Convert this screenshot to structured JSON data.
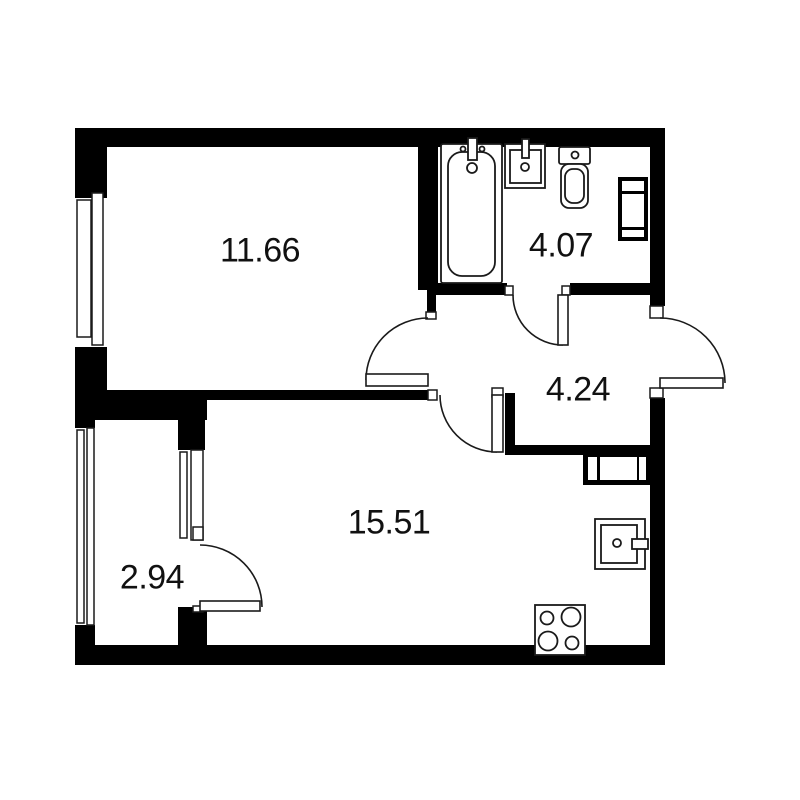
{
  "plan": {
    "canvas": {
      "width": 800,
      "height": 800
    },
    "colors": {
      "background": "#ffffff",
      "wall": "#000000",
      "line": "#1a1a1a",
      "fixture_fill": "#ffffff"
    },
    "rooms": [
      {
        "id": "room-1",
        "area": "11.66",
        "label_x": 260,
        "label_y": 251
      },
      {
        "id": "bathroom",
        "area": "4.07",
        "label_x": 561,
        "label_y": 246
      },
      {
        "id": "hallway",
        "area": "4.24",
        "label_x": 578,
        "label_y": 390
      },
      {
        "id": "kitchen-living",
        "area": "15.51",
        "label_x": 389,
        "label_y": 523
      },
      {
        "id": "balcony",
        "area": "2.94",
        "label_x": 152,
        "label_y": 578
      }
    ],
    "walls": [
      [
        75,
        128,
        590,
        19
      ],
      [
        75,
        147,
        32,
        51
      ],
      [
        75,
        347,
        32,
        43
      ],
      [
        75,
        390,
        132,
        30
      ],
      [
        75,
        420,
        20,
        10
      ],
      [
        75,
        625,
        20,
        22
      ],
      [
        75,
        645,
        590,
        20
      ],
      [
        650,
        128,
        15,
        178
      ],
      [
        650,
        398,
        15,
        247
      ],
      [
        418,
        147,
        20,
        143
      ],
      [
        427,
        290,
        9,
        22
      ],
      [
        207,
        390,
        230,
        10
      ],
      [
        178,
        390,
        27,
        60
      ],
      [
        178,
        607,
        29,
        38
      ],
      [
        430,
        283,
        77,
        12
      ],
      [
        570,
        283,
        80,
        12
      ],
      [
        505,
        393,
        10,
        62
      ],
      [
        505,
        445,
        160,
        10
      ]
    ],
    "windows": [
      {
        "bg": [
          75,
          198,
          20,
          149
        ],
        "strips": [
          [
            77,
            200,
            14,
            137
          ],
          [
            92,
            193,
            11,
            152
          ]
        ]
      },
      {
        "bg": [
          75,
          428,
          20,
          197
        ],
        "strips": [
          [
            77,
            430,
            7,
            193
          ],
          [
            87,
            428,
            7,
            197
          ]
        ]
      },
      {
        "bg": [
          178,
          450,
          27,
          90
        ],
        "strips": [
          [
            180,
            452,
            7,
            86
          ],
          [
            191,
            450,
            12,
            90
          ]
        ]
      }
    ],
    "frames": [
      [
        426,
        312,
        10,
        7
      ],
      [
        428,
        390,
        9,
        10
      ],
      [
        505,
        286,
        8,
        9
      ],
      [
        562,
        286,
        8,
        9
      ],
      [
        492,
        388,
        11,
        9
      ],
      [
        650,
        306,
        13,
        12
      ],
      [
        650,
        388,
        13,
        10
      ],
      [
        193,
        527,
        10,
        13
      ],
      [
        193,
        606,
        10,
        6
      ]
    ],
    "doors": [
      {
        "name": "door-room-1",
        "leaf": [
          366,
          374,
          62,
          12
        ],
        "arc": "M 428 318 A 62 62 0 0 0 366 380"
      },
      {
        "name": "door-bathroom",
        "leaf": [
          558,
          295,
          10,
          50
        ],
        "arc": "M 513 295 A 50 50 0 0 0 563 345"
      },
      {
        "name": "door-kitchen-living",
        "leaf": [
          492,
          395,
          11,
          57
        ],
        "arc": "M 440 395 A 57 57 0 0 0 497 452"
      },
      {
        "name": "door-balcony",
        "leaf": [
          200,
          601,
          60,
          10
        ],
        "arc": "M 200 545 A 62 62 0 0 1 262 607"
      },
      {
        "name": "door-entrance",
        "leaf": [
          660,
          378,
          63,
          10
        ],
        "arc": "M 660 318 A 65 65 0 0 1 725 383"
      }
    ],
    "fixtures": [
      {
        "name": "bathtub",
        "rects": [
          [
            441,
            144,
            61,
            139,
            2
          ],
          [
            448,
            152,
            47,
            124,
            14
          ],
          [
            468,
            138,
            9,
            22,
            0
          ]
        ],
        "circles": [
          [
            463,
            149,
            2.5
          ],
          [
            482,
            149,
            2.5
          ],
          [
            472,
            168,
            5
          ]
        ]
      },
      {
        "name": "bathroom-sink",
        "rects": [
          [
            505,
            144,
            40,
            44,
            0
          ],
          [
            510,
            150,
            31,
            33,
            0
          ],
          [
            522,
            139,
            7,
            19,
            0
          ]
        ],
        "circles": [
          [
            525,
            167,
            4
          ]
        ]
      },
      {
        "name": "toilet",
        "rects": [
          [
            559,
            147,
            31,
            17,
            2
          ],
          [
            561,
            164,
            27,
            44,
            8
          ],
          [
            565,
            169,
            19,
            34,
            8
          ]
        ],
        "circles": [
          [
            575,
            155,
            3.5
          ]
        ]
      },
      {
        "name": "vent-shaft",
        "black_rects": [
          [
            618,
            177,
            30,
            64
          ]
        ],
        "white_rects": [
          [
            622,
            181,
            22,
            10
          ],
          [
            622,
            194,
            22,
            33
          ],
          [
            622,
            230,
            22,
            7
          ]
        ]
      },
      {
        "name": "entry-closet",
        "black_rects": [
          [
            583,
            452,
            67,
            33
          ]
        ],
        "white_rects": [
          [
            588,
            457,
            9,
            23
          ],
          [
            600,
            457,
            37,
            23
          ],
          [
            639,
            457,
            7,
            23
          ]
        ]
      },
      {
        "name": "kitchen-sink",
        "rects": [
          [
            595,
            519,
            50,
            50,
            0
          ],
          [
            601,
            525,
            36,
            38,
            0
          ],
          [
            632,
            539,
            16,
            10,
            0
          ]
        ],
        "circles": [
          [
            617,
            543,
            4
          ]
        ]
      },
      {
        "name": "stove",
        "rects": [
          [
            535,
            605,
            50,
            50,
            0
          ]
        ],
        "circles": [
          [
            547,
            618,
            6.5
          ],
          [
            571,
            617,
            9.5
          ],
          [
            548,
            641,
            9.5
          ],
          [
            572,
            643,
            6.5
          ]
        ]
      }
    ]
  }
}
